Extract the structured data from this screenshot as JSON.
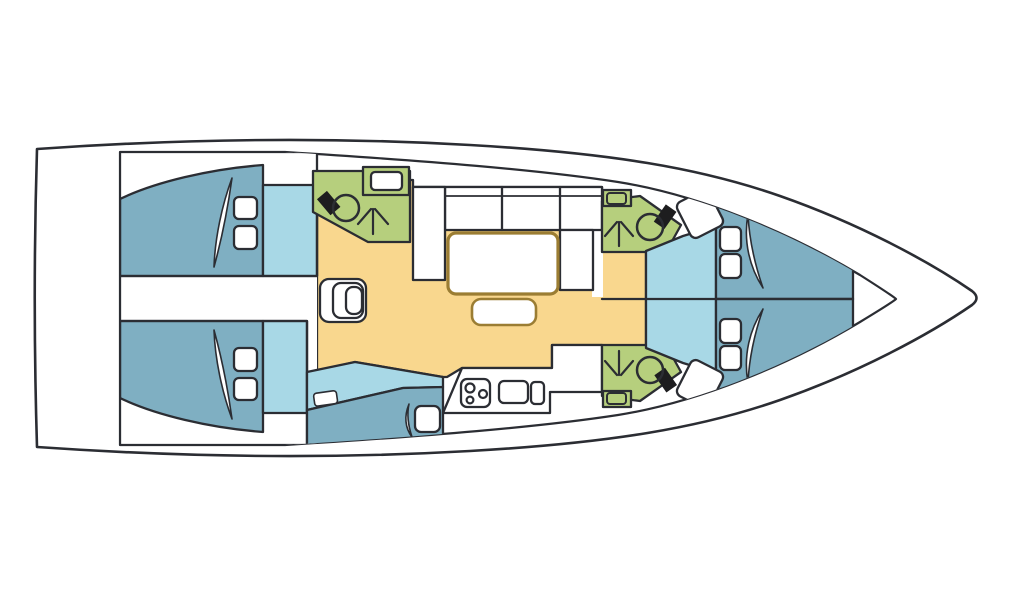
{
  "diagram": {
    "type": "yacht-floor-plan",
    "orientation": "bow-right",
    "rooms": [
      {
        "name": "aft-cabin-port",
        "kind": "cabin",
        "fixtures": [
          "double-bed",
          "two-pillows",
          "blanket"
        ]
      },
      {
        "name": "aft-cabin-starboard",
        "kind": "cabin",
        "fixtures": [
          "double-bed",
          "two-pillows",
          "blanket"
        ]
      },
      {
        "name": "aft-corridor",
        "kind": "passage",
        "fixtures": []
      },
      {
        "name": "head-aft",
        "kind": "bathroom",
        "fixtures": [
          "toilet",
          "shower",
          "sink"
        ]
      },
      {
        "name": "salon",
        "kind": "salon",
        "fixtures": [
          "u-settee",
          "table",
          "bench"
        ]
      },
      {
        "name": "companionway",
        "kind": "steps",
        "fixtures": [
          "three-steps"
        ]
      },
      {
        "name": "nav-berth",
        "kind": "cabin",
        "fixtures": [
          "berth",
          "pillow",
          "blanket",
          "shelf"
        ]
      },
      {
        "name": "galley",
        "kind": "galley",
        "fixtures": [
          "stove-three-burners",
          "double-sink"
        ]
      },
      {
        "name": "head-forward-port",
        "kind": "bathroom",
        "fixtures": [
          "toilet",
          "shower",
          "sink"
        ]
      },
      {
        "name": "head-forward-starboard",
        "kind": "bathroom",
        "fixtures": [
          "toilet",
          "shower",
          "sink"
        ]
      },
      {
        "name": "forward-cabin-port",
        "kind": "cabin",
        "fixtures": [
          "v-berth",
          "two-pillows",
          "blanket"
        ]
      },
      {
        "name": "forward-cabin-starboard",
        "kind": "cabin",
        "fixtures": [
          "v-berth",
          "two-pillows",
          "blanket"
        ]
      }
    ]
  },
  "colors": {
    "outline": "#2b2d33",
    "bed": "#7fafc2",
    "floor": "#a8d8e6",
    "wet": "#b6cf7d",
    "salon": "#f9d78e",
    "furniture": "#ffffff",
    "table_stroke": "#9b7d33",
    "tank": "#1d1d1f",
    "background": "#ffffff"
  }
}
